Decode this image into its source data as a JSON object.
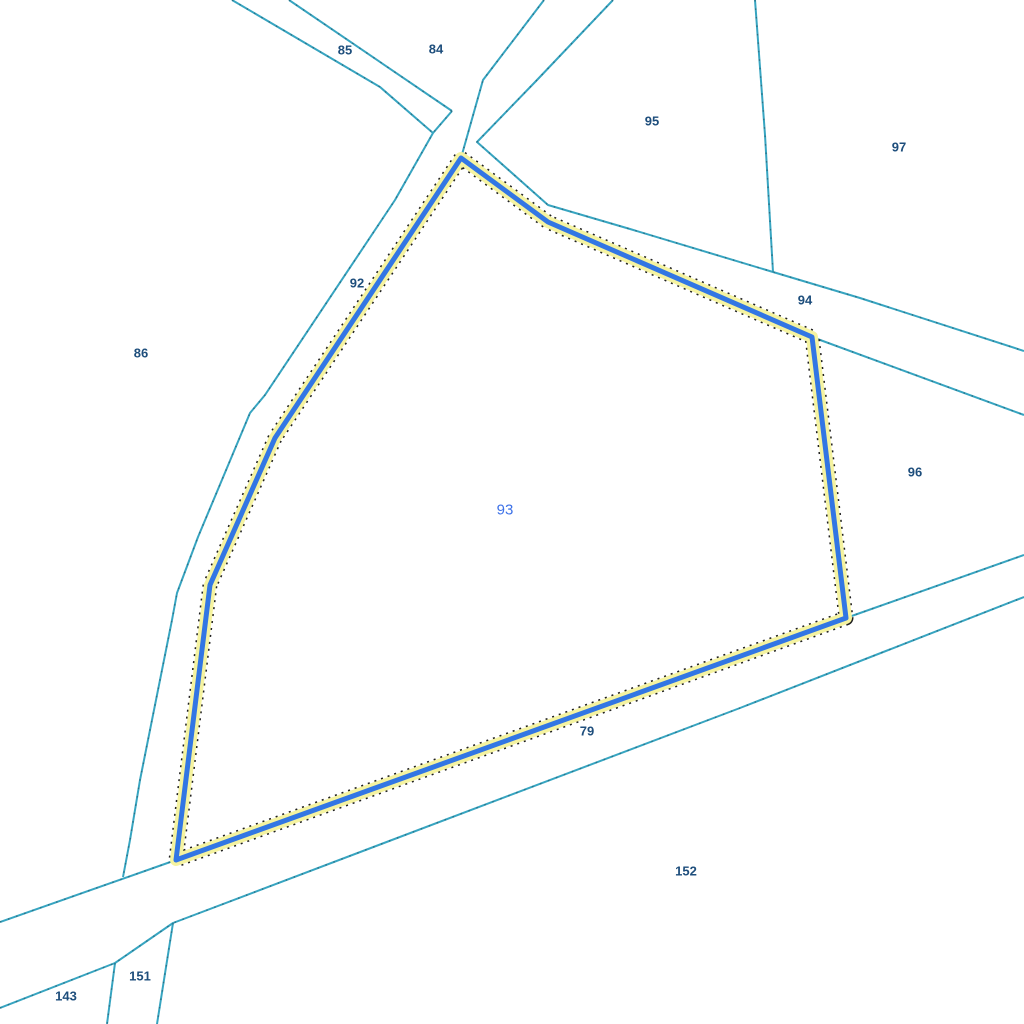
{
  "map": {
    "background": "#ffffff",
    "colors": {
      "boundary_teal": "#37a5c1",
      "boundary_dot": "#1f3f4d",
      "highlight_outline_black": "#1f1f1f",
      "highlight_yellow": "#f5f3a0",
      "highlight_blue": "#3276e4",
      "label_navy": "#1e4e7c",
      "selected_label_blue": "#3e72e8"
    },
    "selected_parcel": {
      "id": "93",
      "label": {
        "text": "93",
        "x": 505,
        "y": 510
      },
      "points": [
        [
          461,
          158
        ],
        [
          548,
          222
        ],
        [
          812,
          337
        ],
        [
          846,
          618
        ],
        [
          176,
          860
        ],
        [
          210,
          585
        ],
        [
          275,
          438
        ]
      ]
    },
    "boundary_lines": [
      {
        "name": "road-nw-upper",
        "points": [
          [
            289,
            0
          ],
          [
            452,
            111
          ]
        ]
      },
      {
        "name": "road-nw-lower",
        "points": [
          [
            232,
            0
          ],
          [
            380,
            87
          ],
          [
            433,
            133
          ]
        ]
      },
      {
        "name": "road-west-east-side",
        "points": [
          [
            544,
            0
          ],
          [
            483,
            80
          ],
          [
            461,
            158
          ]
        ]
      },
      {
        "name": "road-west-west-side",
        "points": [
          [
            452,
            111
          ],
          [
            433,
            133
          ],
          [
            395,
            200
          ],
          [
            265,
            395
          ],
          [
            250,
            413
          ],
          [
            198,
            537
          ],
          [
            177,
            593
          ],
          [
            172,
            620
          ],
          [
            140,
            780
          ],
          [
            130,
            840
          ],
          [
            123,
            877
          ]
        ]
      },
      {
        "name": "road-ne-upper",
        "points": [
          [
            613,
            0
          ],
          [
            537,
            80
          ],
          [
            477,
            142
          ],
          [
            548,
            205
          ],
          [
            630,
            229
          ],
          [
            773,
            272
          ],
          [
            860,
            298
          ],
          [
            1024,
            351
          ]
        ]
      },
      {
        "name": "parcel-95-97-boundary",
        "points": [
          [
            755,
            0
          ],
          [
            765,
            135
          ],
          [
            773,
            272
          ]
        ]
      },
      {
        "name": "branch-ne",
        "points": [
          [
            812,
            337
          ],
          [
            1024,
            415
          ]
        ]
      },
      {
        "name": "road-se-upper",
        "points": [
          [
            0,
            922
          ],
          [
            176,
            860
          ],
          [
            846,
            618
          ],
          [
            1024,
            555
          ]
        ]
      },
      {
        "name": "road-se-lower",
        "points": [
          [
            0,
            1008
          ],
          [
            115,
            963
          ],
          [
            173,
            923
          ],
          [
            740,
            708
          ],
          [
            1024,
            597
          ]
        ]
      },
      {
        "name": "branch-152-151",
        "points": [
          [
            173,
            923
          ],
          [
            157,
            1024
          ]
        ]
      },
      {
        "name": "branch-151-143",
        "points": [
          [
            115,
            963
          ],
          [
            107,
            1024
          ]
        ]
      }
    ],
    "labels": [
      {
        "text": "85",
        "x": 345,
        "y": 50
      },
      {
        "text": "84",
        "x": 436,
        "y": 49
      },
      {
        "text": "95",
        "x": 652,
        "y": 121
      },
      {
        "text": "97",
        "x": 899,
        "y": 147
      },
      {
        "text": "92",
        "x": 357,
        "y": 283
      },
      {
        "text": "86",
        "x": 141,
        "y": 353
      },
      {
        "text": "94",
        "x": 805,
        "y": 300
      },
      {
        "text": "96",
        "x": 915,
        "y": 472
      },
      {
        "text": "79",
        "x": 587,
        "y": 731
      },
      {
        "text": "152",
        "x": 686,
        "y": 871
      },
      {
        "text": "151",
        "x": 140,
        "y": 976
      },
      {
        "text": "143",
        "x": 66,
        "y": 996
      }
    ]
  }
}
